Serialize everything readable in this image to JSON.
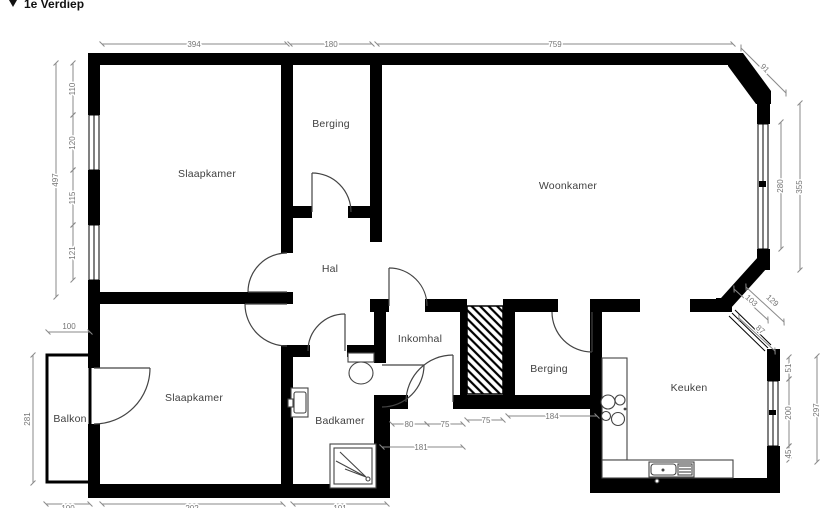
{
  "title": {
    "icon": "▼",
    "text": "1e Verdiep"
  },
  "colors": {
    "wall": "#000000",
    "dim_line": "#8a8a8a",
    "dim_text": "#757575",
    "room_label": "#3f3f3f",
    "background": "#ffffff"
  },
  "room_labels": {
    "slaapkamer_top": "Slaapkamer",
    "berging_top": "Berging",
    "woonkamer": "Woonkamer",
    "hal": "Hal",
    "inkomhal": "Inkomhal",
    "berging_bottom": "Berging",
    "keuken": "Keuken",
    "badkamer": "Badkamer",
    "balkon": "Balkon",
    "slaapkamer_bottom": "Slaapkamer"
  },
  "dimensions": {
    "top": {
      "slaapkamer_width": "394",
      "berging_width": "180",
      "woonkamer_width": "759",
      "bay_corner": "91"
    },
    "left": {
      "slaapkamer_total": "497",
      "seg_top": "110",
      "window_top": "120",
      "seg_mid": "115",
      "window_bottom": "121",
      "balkon_width": "100",
      "balkon_depth": "281"
    },
    "right": {
      "bay_window": "280",
      "bay_total": "355",
      "diag_a": "103",
      "diag_b": "129",
      "diag_window": "87",
      "keuken_seg_top": "51",
      "keuken_window": "200",
      "keuken_seg_bottom": "45",
      "keuken_total": "297"
    },
    "middle": {
      "badkamer_door": "80",
      "seg_a": "75",
      "shaft": "75",
      "berging_width": "184",
      "inkomhal_width": "181"
    },
    "bottom": {
      "left": "100",
      "center": "202",
      "right": "101"
    }
  }
}
